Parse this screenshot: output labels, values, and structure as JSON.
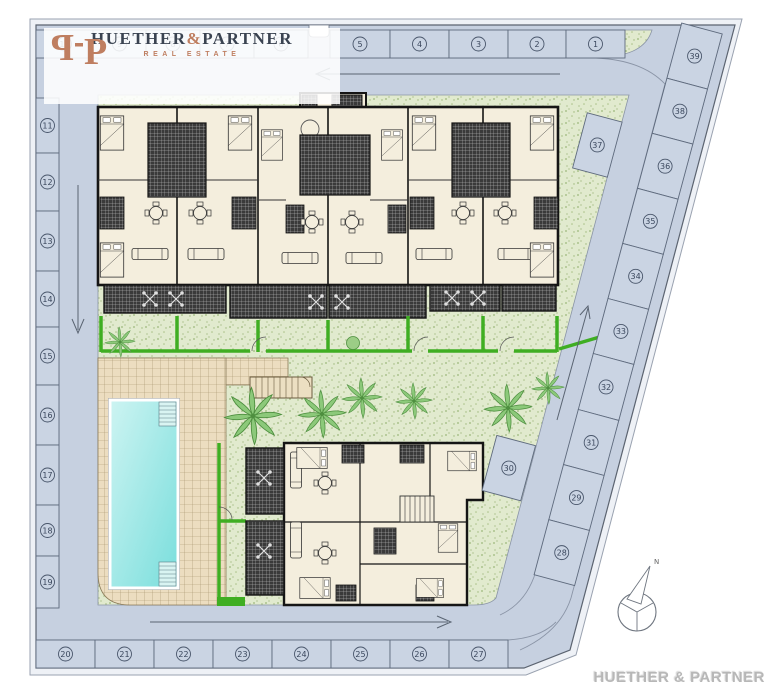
{
  "meta": {
    "type": "architectural-site-plan"
  },
  "colors": {
    "road": "#c6d0e0",
    "stall_fill": "#cad4e3",
    "kerb": "#8a94a6",
    "green": "#e1eace",
    "hedge": "#3fae22",
    "cream": "#f4eedd",
    "wall": "#151515",
    "deck": "#ecddc0",
    "pool_light": "#cdf4f2",
    "pool_dark": "#79dedc",
    "copper": "#bf7e60",
    "navy": "#3a4351",
    "watermark": "#b7b7b7"
  },
  "logo": {
    "monogram_letter": "P",
    "name_left": "HUETHER",
    "ampersand": "&",
    "name_right": "PARTNER",
    "tagline": "REAL ESTATE"
  },
  "watermark": {
    "text": "HUETHER & PARTNER"
  },
  "compass": {
    "north_label": "N"
  },
  "parking": {
    "top_row": [
      "10",
      "9",
      "8",
      "7",
      "6",
      "5",
      "4",
      "3",
      "2",
      "1"
    ],
    "left_column": [
      "11",
      "12",
      "13",
      "14",
      "15",
      "16",
      "17",
      "18",
      "19"
    ],
    "bottom_row": [
      "20",
      "21",
      "22",
      "23",
      "24",
      "25",
      "26",
      "27"
    ],
    "diagonal_row": [
      "39",
      "38",
      "36",
      "35",
      "34",
      "33",
      "32",
      "31",
      "29",
      "28"
    ],
    "inner_stalls": [
      "37",
      "30"
    ]
  }
}
